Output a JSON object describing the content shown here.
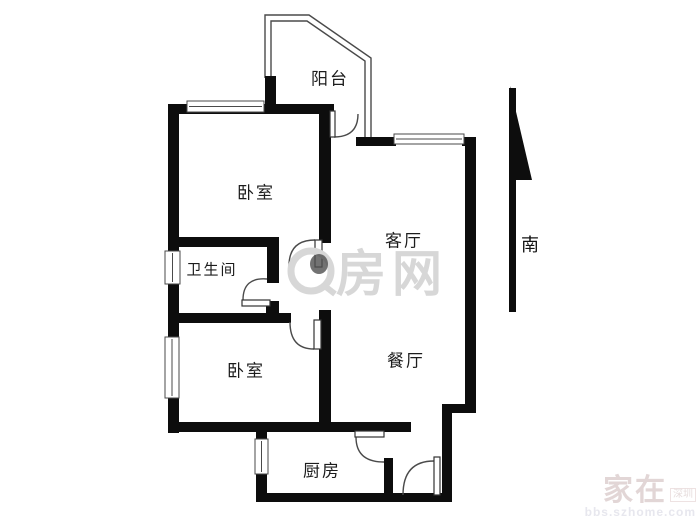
{
  "canvas": {
    "width": 700,
    "height": 525,
    "background": "#ffffff"
  },
  "palette": {
    "wall": "#0d0d0d",
    "line": "#4a4a4a",
    "window_fill": "#ffffff",
    "label": "#1c1c1c",
    "watermark_gray": "#d7d7d7",
    "watermark_dot": "#4f4f4f",
    "watermark_corner": "#e2d6d6"
  },
  "rooms": [
    {
      "id": "balcony",
      "label": "阳台",
      "x": 330,
      "y": 77,
      "size": 17
    },
    {
      "id": "bedroom-north",
      "label": "卧室",
      "x": 256,
      "y": 191,
      "size": 17
    },
    {
      "id": "bathroom",
      "label": "卫生间",
      "x": 212,
      "y": 269,
      "size": 15
    },
    {
      "id": "living-room",
      "label": "客厅",
      "x": 404,
      "y": 239,
      "size": 17
    },
    {
      "id": "bedroom-south",
      "label": "卧室",
      "x": 246,
      "y": 369,
      "size": 17
    },
    {
      "id": "dining-room",
      "label": "餐厅",
      "x": 406,
      "y": 359,
      "size": 17
    },
    {
      "id": "kitchen",
      "label": "厨房",
      "x": 322,
      "y": 469,
      "size": 17
    }
  ],
  "compass": {
    "label": "南",
    "shaft": [
      509,
      88,
      7,
      224
    ],
    "head": "510,86 532,180 510,180"
  },
  "walls": [
    {
      "n": "bedroom-north-top",
      "x": 168,
      "y": 104,
      "w": 166,
      "h": 10
    },
    {
      "n": "exterior-left",
      "x": 168,
      "y": 104,
      "w": 11,
      "h": 329
    },
    {
      "n": "bedroom-north-bottom",
      "x": 168,
      "y": 237,
      "w": 110,
      "h": 10
    },
    {
      "n": "bathroom-right-upper",
      "x": 267,
      "y": 237,
      "w": 12,
      "h": 46
    },
    {
      "n": "bathroom-right-block",
      "x": 266,
      "y": 301,
      "w": 13,
      "h": 13
    },
    {
      "n": "bedroom-south-top",
      "x": 168,
      "y": 313,
      "w": 123,
      "h": 10
    },
    {
      "n": "living-left",
      "x": 319,
      "y": 104,
      "w": 12,
      "h": 139
    },
    {
      "n": "dining-left",
      "x": 319,
      "y": 310,
      "w": 12,
      "h": 118
    },
    {
      "n": "south-corridor",
      "x": 168,
      "y": 422,
      "w": 243,
      "h": 10
    },
    {
      "n": "kitchen-left",
      "x": 256,
      "y": 428,
      "w": 11,
      "h": 73
    },
    {
      "n": "bottom",
      "x": 256,
      "y": 493,
      "w": 196,
      "h": 9
    },
    {
      "n": "kitchen-right",
      "x": 384,
      "y": 458,
      "w": 9,
      "h": 37
    },
    {
      "n": "entrance-right",
      "x": 442,
      "y": 405,
      "w": 10,
      "h": 97
    },
    {
      "n": "right-jog",
      "x": 442,
      "y": 404,
      "w": 34,
      "h": 9
    },
    {
      "n": "exterior-right",
      "x": 465,
      "y": 137,
      "w": 11,
      "h": 270
    },
    {
      "n": "living-top-left",
      "x": 356,
      "y": 137,
      "w": 40,
      "h": 9
    },
    {
      "n": "living-top-right",
      "x": 462,
      "y": 137,
      "w": 14,
      "h": 9
    },
    {
      "n": "balcony-left",
      "x": 265,
      "y": 76,
      "w": 11,
      "h": 30
    }
  ],
  "windows": [
    {
      "n": "bedroom-north-window",
      "x": 187,
      "y": 101,
      "w": 77,
      "h": 11,
      "dir": "h"
    },
    {
      "n": "living-room-window",
      "x": 394,
      "y": 134,
      "w": 70,
      "h": 10,
      "dir": "h"
    },
    {
      "n": "bathroom-window",
      "x": 165,
      "y": 251,
      "w": 15,
      "h": 33,
      "dir": "v"
    },
    {
      "n": "bedroom-south-window",
      "x": 165,
      "y": 337,
      "w": 14,
      "h": 61,
      "dir": "v"
    },
    {
      "n": "kitchen-window",
      "x": 255,
      "y": 439,
      "w": 13,
      "h": 35,
      "dir": "v"
    }
  ],
  "doors": [
    {
      "n": "balcony-door",
      "leaf": [
        330,
        111,
        5,
        26
      ],
      "arc": "M 334 137 Q 358 137 358 114"
    },
    {
      "n": "bedroom-north-door",
      "leaf": [
        315,
        240,
        7,
        27
      ],
      "arc": "M 289 266 Q 289 240 315 240"
    },
    {
      "n": "bathroom-door",
      "leaf": [
        242,
        300,
        28,
        6
      ],
      "arc": "M 243 300 Q 243 277 267 279"
    },
    {
      "n": "bedroom-south-door",
      "leaf": [
        314,
        320,
        7,
        29
      ],
      "arc": "M 290 322 Q 290 349 314 349"
    },
    {
      "n": "kitchen-door",
      "leaf": [
        355,
        431,
        29,
        6
      ],
      "arc": "M 356 437 Q 356 462 384 462"
    },
    {
      "n": "entrance-door",
      "leaf": [
        434,
        457,
        6,
        38
      ],
      "arc": "M 403 495 Q 403 461 434 461"
    }
  ],
  "railing": {
    "outer": "265,78 265,15 309,15 371,58 371,138",
    "inner": "271,78 271,21 307,21 365,61 365,138"
  },
  "watermark_center": {
    "text": "房网",
    "circle": {
      "cx": 311,
      "cy": 271,
      "r": 20
    },
    "dot": {
      "cx": 319,
      "cy": 264,
      "rx": 9,
      "ry": 10
    },
    "tail": [
      326,
      287,
      335,
      294
    ],
    "text_x": 336,
    "text_y": 291,
    "font": 50
  },
  "watermark_corner": {
    "title": "家在",
    "badge": "深圳",
    "subtitle": "bbs.szhome.com"
  }
}
